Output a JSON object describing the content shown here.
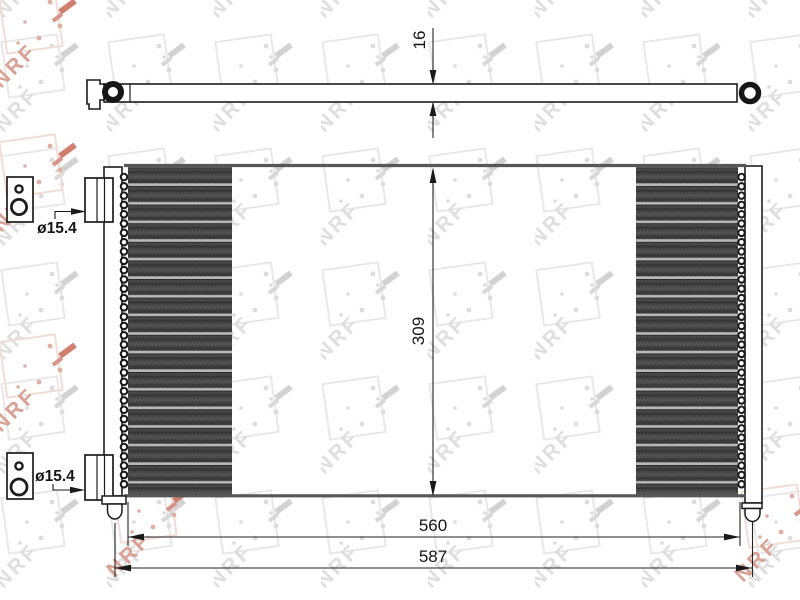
{
  "drawing": {
    "type": "condenser-technical-drawing",
    "dimensions": {
      "bar_thickness": "16",
      "core_height": "309",
      "core_width": "560",
      "overall_width": "587"
    },
    "port_labels": {
      "top": "ø15.4",
      "bottom": "ø15.4"
    }
  },
  "watermark": {
    "brand": "NRF"
  },
  "colors": {
    "line": "#1c1c1c",
    "header_gray": "#575757",
    "fin_dark": "#474747",
    "tube_light": "#b8b8b8",
    "watermark_gray": "#dfdfdf",
    "watermark_red": "#d9a193",
    "background": "#ffffff"
  }
}
